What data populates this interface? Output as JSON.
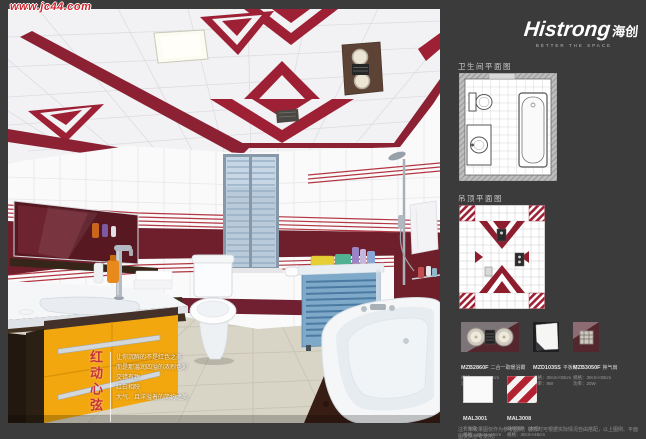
{
  "watermark": {
    "text": "www.jc44.com"
  },
  "brand": {
    "name": "Histrong",
    "name_cn": "海创",
    "tagline": "BETTER THE SPACE"
  },
  "scene": {
    "slogan_vertical": "红动心弦",
    "slogan_lines": [
      "让你沉醉的不是红色之美",
      "而是那温润四溢的浓烈色彩",
      "交错有致",
      "红白相映",
      "大气、且洋溢着的简约之美"
    ]
  },
  "panel": {
    "sections": {
      "floorplan_title": "卫生间平面图",
      "ceiling_title": "吊顶平面图"
    },
    "products": [
      {
        "code": "MZB2860F",
        "name": "二合一取暖浴霸",
        "line1": "规格：30cm×60cm",
        "line2": "功率：1100W"
      },
      {
        "code": "MZD1035S",
        "name": "平板灯",
        "line1": "规格：30cm×30cm",
        "line2": "功率：8W"
      },
      {
        "code": "MZB3050F",
        "name": "换气扇",
        "line1": "规格：30cm×30cm",
        "line2": "功率：20W"
      },
      {
        "code": "MAL3001",
        "name": "亮光白",
        "line1": "规格：30cm×45cm",
        "line2": ""
      },
      {
        "code": "MAL3008",
        "name": "斜纹饰件（大红）",
        "line1": "规格：30cm×45cm",
        "line2": ""
      }
    ],
    "note": "注：本效果图仅作为参考图例，装修时可根据实际情况自由搭配，以上图例、平面图仅供参考使用。"
  },
  "colors": {
    "page_background": "#3b3b3b",
    "accent_red": "#9e2034",
    "band_maroon": "#6f1f2b",
    "cabinet_yellow": "#f3a70e",
    "blind_blue": "#b9cbdb",
    "floor_beige": "#d8d4c6"
  }
}
